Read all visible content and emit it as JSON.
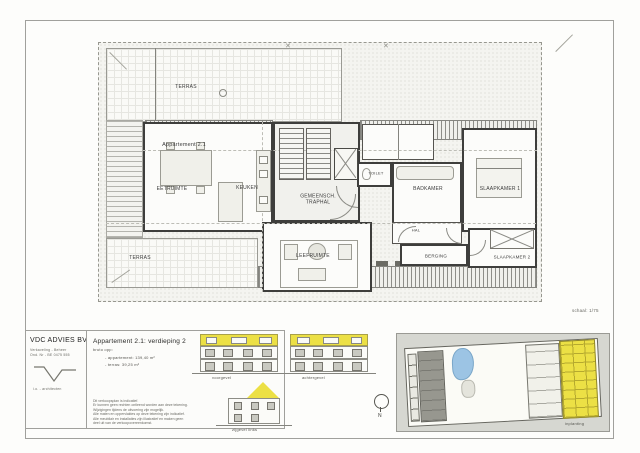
{
  "page": {
    "scale_label": "schaal: 1/75"
  },
  "plan": {
    "labels": {
      "terras_top": "TERRAS",
      "apartment": "Appartement 2.1",
      "eetruimte": "EETRUIMTE",
      "keuken": "KEUKEN",
      "traphal_line1": "GEMEENSCH.",
      "traphal_line2": "TRAPHAL",
      "toilet": "TOILET",
      "badkamer": "BADKAMER",
      "slaapkamer1": "SLAAPKAMER 1",
      "leefruimte": "LEEFRUIMTE",
      "hal": "HAL",
      "berging": "BERGING",
      "slaapkamer2": "SLAAPKAMER 2",
      "terras_bottom": "TERRAS"
    }
  },
  "titleblock": {
    "company": "VDC ADVIES BV",
    "sub1": "Verkaveling - Beheer",
    "sub2": "Ond. Nr - BE 0475 555",
    "logo_caption": "i.o. - architecten"
  },
  "info": {
    "title": "Appartement 2.1: verdieping 2",
    "subtitle": "bruto opp:",
    "area_line1": "- appartement: 139,40 m²",
    "area_line2": "- terras: 39,25 m²",
    "disclaimer": [
      "Dit verkoopsplan is indicatief.",
      "Er kunnen geen rechten ontleend worden aan deze tekening.",
      "Wijzigingen tijdens de uitvoering zijn mogelijk.",
      "Alle maten en oppervlaktes op deze tekening zijn indicatief.",
      "Alle meubilair en installaties zijn illustratief en maken geen",
      "deel uit van de verkoopovereenkomst."
    ]
  },
  "elevations": {
    "front": "voorgevel",
    "rear": "achtergevel",
    "side": "zijgevel links"
  },
  "north_label": "N",
  "siteplan_label": "inplanting",
  "colors": {
    "highlight_yellow": "#ece045",
    "pool_blue": "#9cc4e4",
    "panel_gray": "#d6d7d1"
  }
}
